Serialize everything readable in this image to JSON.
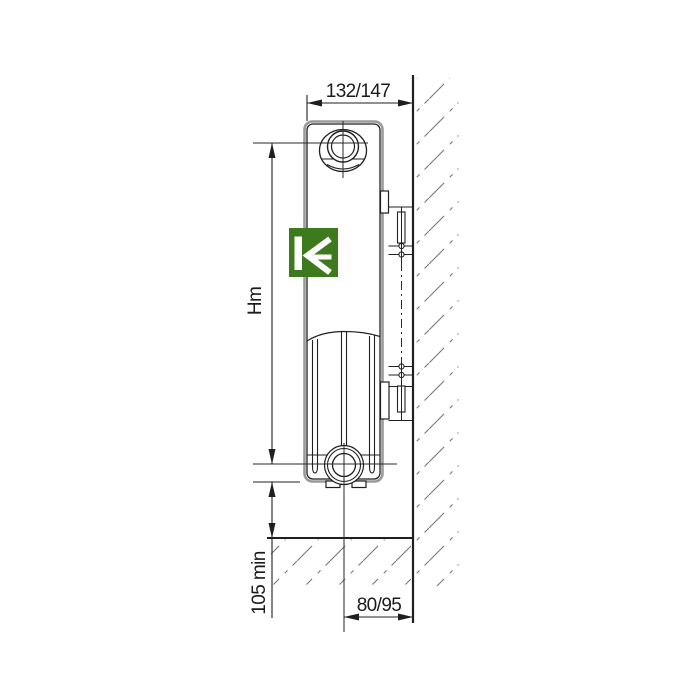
{
  "drawing": {
    "labels": {
      "top_width": "132/147",
      "mounting_height": "Hm",
      "min_floor_clearance": "105 min",
      "wall_distance": "80/95"
    },
    "logo": {
      "icon": "kermi-k-logo",
      "background": "#3d7a1d",
      "glyph_color": "#ffffff"
    },
    "colors": {
      "line": "#1f1f1f",
      "edge_gray": "#9a9a9a",
      "hatch": "#787878",
      "background": "#ffffff"
    }
  }
}
